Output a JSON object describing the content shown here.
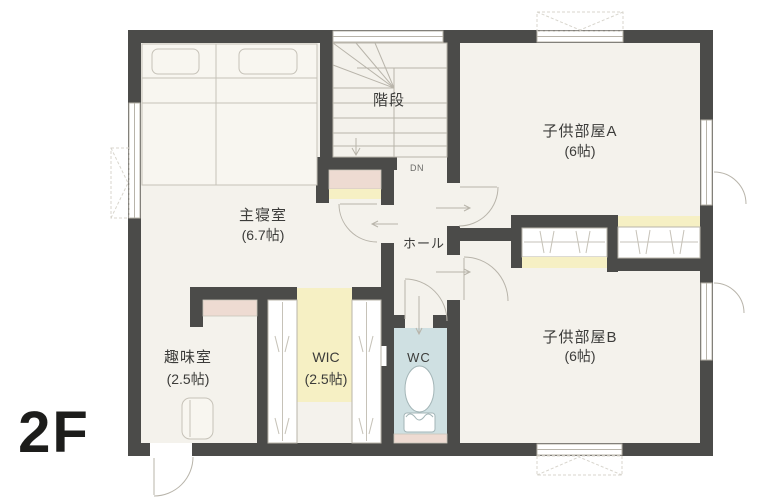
{
  "floor_label": "2F",
  "rooms": {
    "master_bedroom": {
      "name": "主寝室",
      "size": "(6.7帖)"
    },
    "stairs": {
      "name": "階段",
      "direction": "DN"
    },
    "hall": {
      "name": "ホール"
    },
    "child_room_a": {
      "name": "子供部屋A",
      "size": "(6帖)"
    },
    "child_room_b": {
      "name": "子供部屋B",
      "size": "(6帖)"
    },
    "hobby_room": {
      "name": "趣味室",
      "size": "(2.5帖)"
    },
    "wic": {
      "name": "WIC",
      "size": "(2.5帖)"
    },
    "wc": {
      "name": "WC"
    }
  },
  "colors": {
    "wall": "#4b4b49",
    "floor": "#f4f2ec",
    "line": "#b8b4aa",
    "text": "#3c3c3a",
    "wcblue": "#cfe0e2",
    "yellow": "#f6f0c4",
    "pink": "#eedbd2"
  }
}
